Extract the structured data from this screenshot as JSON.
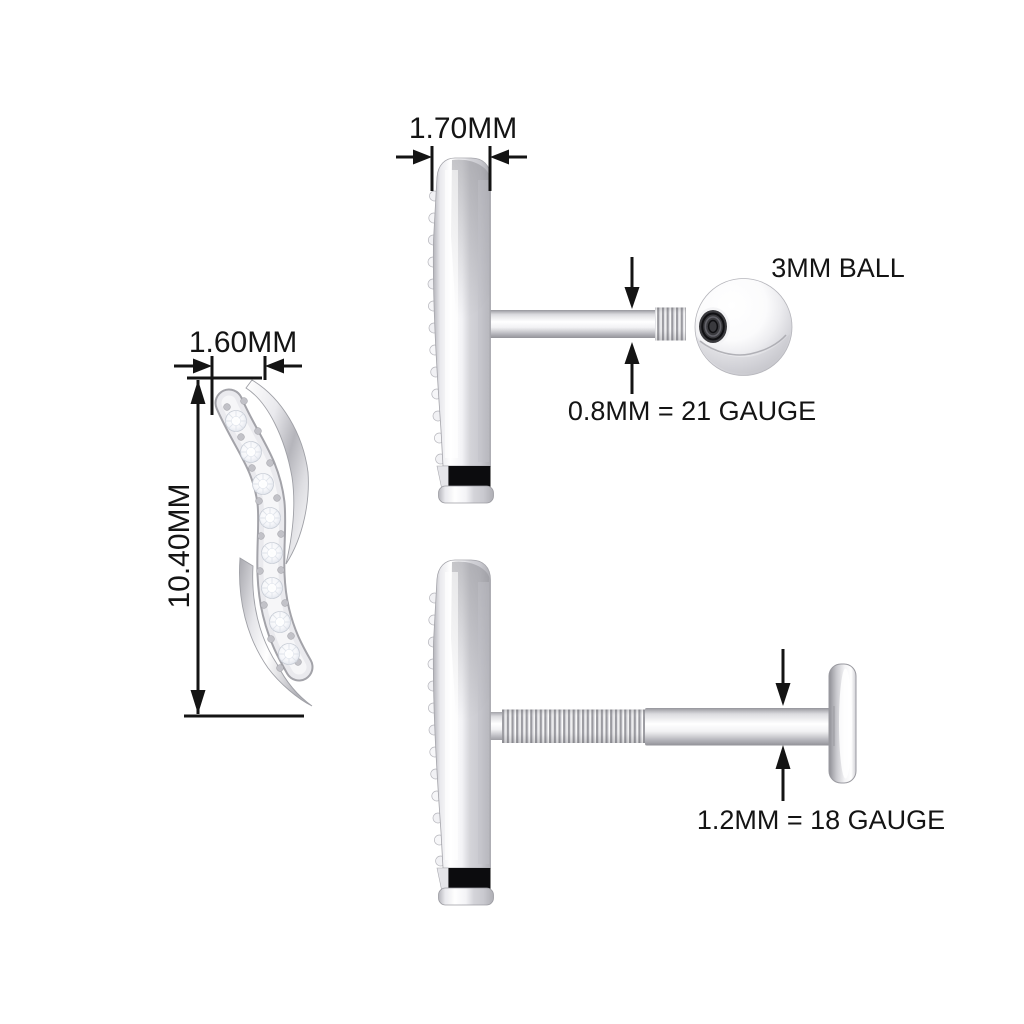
{
  "diagram": {
    "description": "Technical dimension diagram of a curved pave-set earring shown in front view and two side views (screw-back ball version and flat-back labret version)",
    "labels": {
      "front_width": "1.60MM",
      "front_height": "10.40MM",
      "side_thickness": "1.70MM",
      "ball": "3MM BALL",
      "screw_post_gauge": "0.8MM = 21 GAUGE",
      "flat_post_gauge": "1.2MM = 18 GAUGE"
    },
    "front_view": {
      "diamond_count": 8
    },
    "colors": {
      "background": "#ffffff",
      "ink": "#141414",
      "metal_light": "#ffffff",
      "metal_mid": "#d8d8dd",
      "metal_dark": "#9b9ba1",
      "notch_black": "#0c0c0e"
    }
  }
}
